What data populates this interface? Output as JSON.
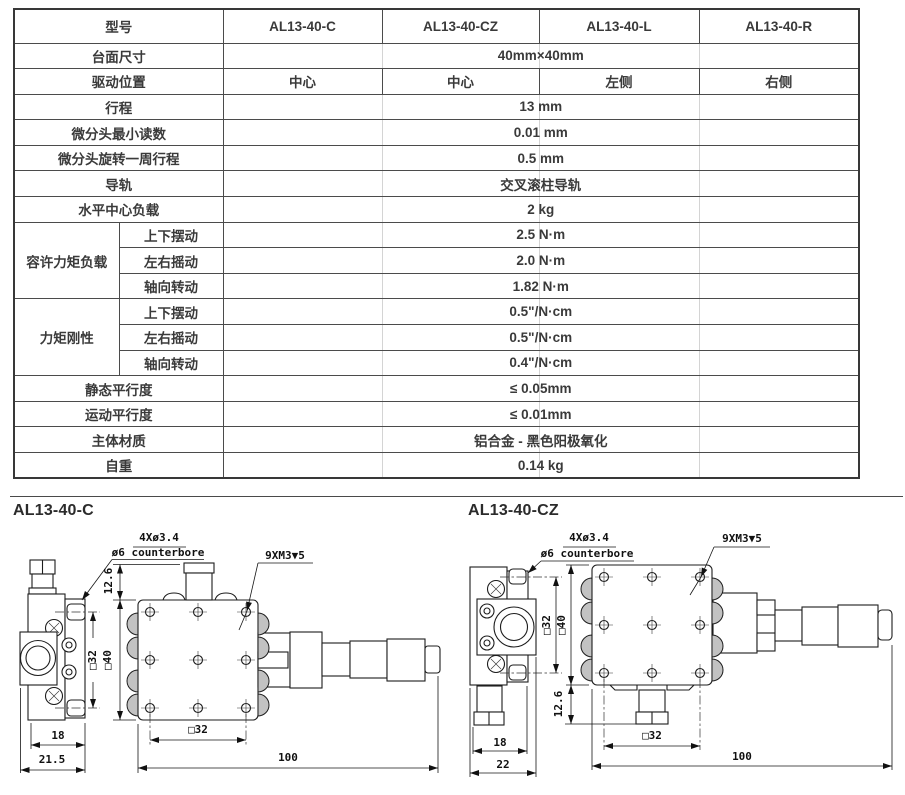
{
  "table": {
    "col_header_label": "型号",
    "models": [
      "AL13-40-C",
      "AL13-40-CZ",
      "AL13-40-L",
      "AL13-40-R"
    ],
    "rows": {
      "surface": {
        "label": "台面尺寸",
        "value": "40mm×40mm"
      },
      "drive_pos": {
        "label": "驱动位置",
        "values": [
          "中心",
          "中心",
          "左侧",
          "右侧"
        ]
      },
      "travel": {
        "label": "行程",
        "value": "13 mm"
      },
      "min_reading": {
        "label": "微分头最小读数",
        "value": "0.01 mm"
      },
      "per_rev": {
        "label": "微分头旋转一周行程",
        "value": "0.5 mm"
      },
      "guide": {
        "label": "导轨",
        "value": "交叉滚柱导轨"
      },
      "load": {
        "label": "水平中心负载",
        "value": "2 kg"
      },
      "moment_load": {
        "label": "容许力矩负载",
        "sub": [
          {
            "label": "上下摆动",
            "value": "2.5 N·m"
          },
          {
            "label": "左右摇动",
            "value": "2.0 N·m"
          },
          {
            "label": "轴向转动",
            "value": "1.82 N·m"
          }
        ]
      },
      "stiffness": {
        "label": "力矩刚性",
        "sub": [
          {
            "label": "上下摆动",
            "value": "0.5\"/N·cm"
          },
          {
            "label": "左右摇动",
            "value": "0.5\"/N·cm"
          },
          {
            "label": "轴向转动",
            "value": "0.4\"/N·cm"
          }
        ]
      },
      "static_par": {
        "label": "静态平行度",
        "value": "≤ 0.05mm"
      },
      "motion_par": {
        "label": "运动平行度",
        "value": "≤ 0.01mm"
      },
      "material": {
        "label": "主体材质",
        "value": "铝合金 - 黑色阳极氧化"
      },
      "weight": {
        "label": "自重",
        "value": "0.14 kg"
      }
    }
  },
  "drawings": {
    "left": {
      "title": "AL13-40-C",
      "callouts": {
        "holes": "4Xø3.4",
        "cbore": "ø6 counterbore",
        "tap": "9XM3▼5"
      },
      "dims": {
        "knob_height": "12.6",
        "side_hole_pitch": "□32",
        "table_size": "□40",
        "body_width": "18",
        "total_width": "21.5",
        "hole_pitch": "□32",
        "overall_length": "100"
      }
    },
    "right": {
      "title": "AL13-40-CZ",
      "callouts": {
        "holes": "4Xø3.4",
        "cbore": "ø6 counterbore",
        "tap": "9XM3▼5"
      },
      "dims": {
        "knob_height": "12.6",
        "side_hole_pitch": "□32",
        "table_size": "□40",
        "body_width": "18",
        "total_width": "22",
        "hole_pitch": "□32",
        "overall_length": "100"
      }
    }
  }
}
